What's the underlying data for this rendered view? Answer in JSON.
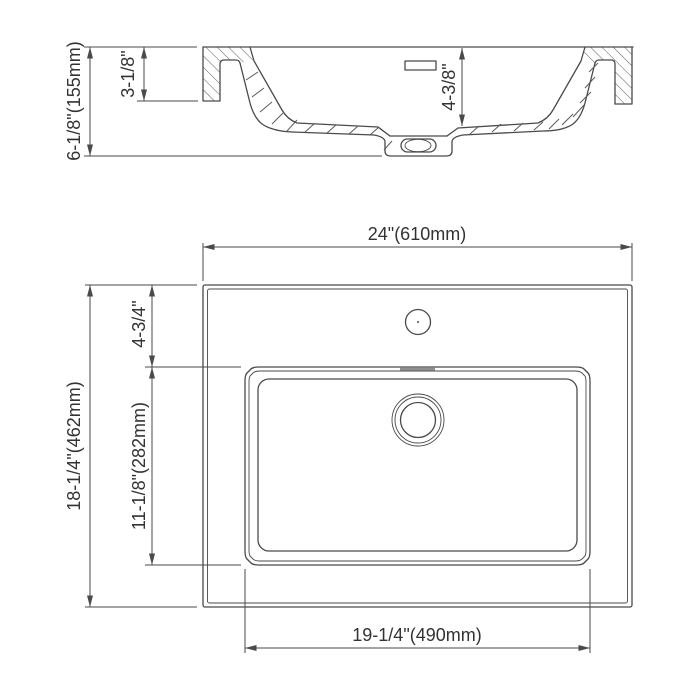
{
  "side_view": {
    "overall_height": "6-1/8\"(155mm)",
    "deck_edge_height": "3-1/8\"",
    "bowl_depth": "4-3/8\""
  },
  "plan_view": {
    "overall_width": "24\"(610mm)",
    "overall_depth": "18-1/4\"(462mm)",
    "bowl_offset_from_back": "4-3/4\"",
    "bowl_length": "11-1/8\"(282mm)",
    "bowl_width": "19-1/4\"(490mm)"
  },
  "colors": {
    "line": "#4a4a4a",
    "text": "#333333",
    "background": "#ffffff"
  }
}
